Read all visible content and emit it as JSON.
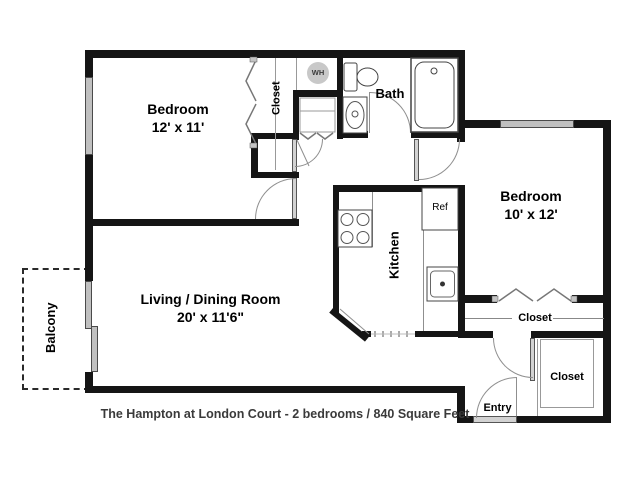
{
  "meta": {
    "caption": "The Hampton at London Court - 2 bedrooms / 840 Square Feet",
    "bedroom_count": "2",
    "square_feet": "840"
  },
  "rooms": {
    "bedroom1": {
      "name": "Bedroom",
      "dims": "12' x 11'"
    },
    "bedroom2": {
      "name": "Bedroom",
      "dims": "10' x 12'"
    },
    "living": {
      "name": "Living / Dining Room",
      "dims": "20' x 11'6\""
    },
    "bath": {
      "name": "Bath"
    },
    "kitchen": {
      "name": "Kitchen"
    },
    "balcony": {
      "name": "Balcony"
    },
    "entry": {
      "name": "Entry"
    }
  },
  "labels": {
    "closet_bedroom1": "Closet",
    "closet_hall": "Closet",
    "closet_entry": "Closet",
    "water_heater": "WH",
    "refrigerator": "Ref"
  },
  "colors": {
    "wall": "#151515",
    "window": "#c0c0c0",
    "door_leaf": "#d2d2d2",
    "water_heater_fill": "#c8c8c8",
    "caption_text": "#3a3a3a",
    "fixture_stroke": "#444444"
  }
}
